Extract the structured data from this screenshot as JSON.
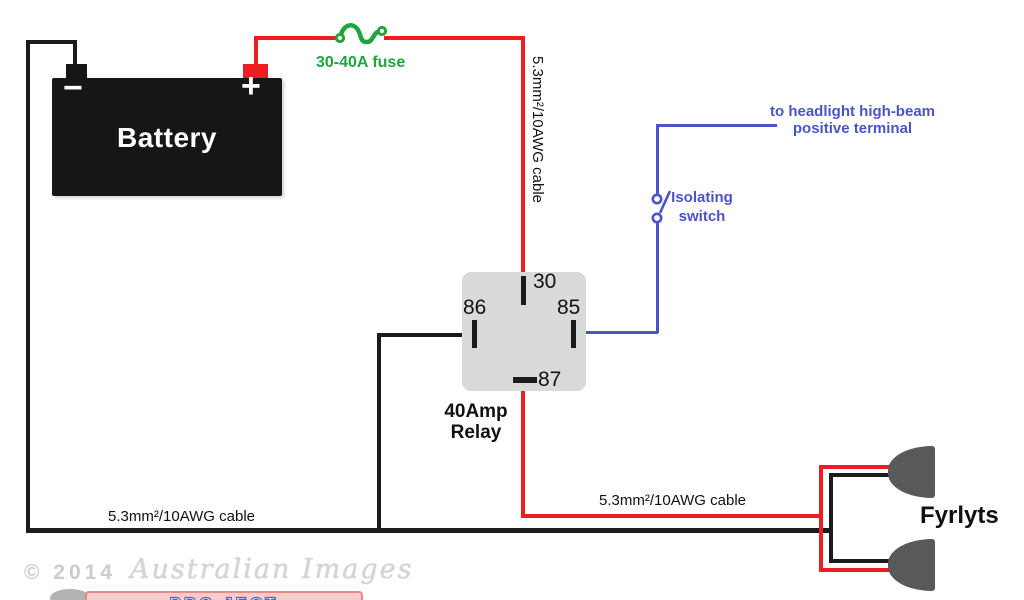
{
  "colors": {
    "wire_red": "#ee1c23",
    "wire_black": "#1b1b1b",
    "wire_blue": "#4a54c8",
    "fuse_green": "#1fa53c",
    "relay_fill": "#d9dbdb",
    "lamp_gray": "#58595b",
    "battery_fill": "#161616"
  },
  "battery": {
    "label": "Battery",
    "minus_label": "−",
    "plus_label": "+"
  },
  "fuse": {
    "label": "30-40A fuse"
  },
  "cables": {
    "battery_to_relay": "5.3mm²/10AWG cable",
    "ground_cable": "5.3mm²/10AWG cable",
    "relay_to_lights": "5.3mm²/10AWG cable"
  },
  "relay": {
    "terminal_30": "30",
    "terminal_85": "85",
    "terminal_86": "86",
    "terminal_87": "87",
    "name_line1": "40Amp",
    "name_line2": "Relay"
  },
  "isolating_switch": {
    "label_line1": "Isolating",
    "label_line2": "switch"
  },
  "headlight_note": {
    "line1": "to headlight high-beam",
    "line2": "positive terminal"
  },
  "lights": {
    "label": "Fyrlyts"
  },
  "watermark": {
    "copyright": "© 2014",
    "brand": "Australian Images",
    "logo_text": "PRO JECT"
  }
}
